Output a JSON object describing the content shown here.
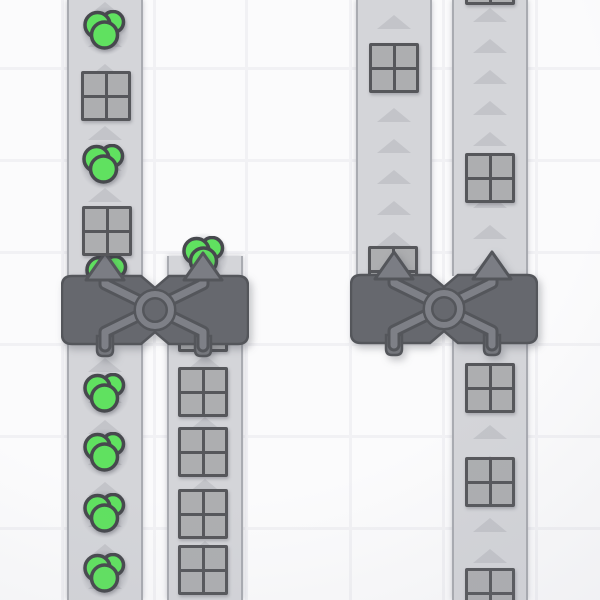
{
  "scene": {
    "description": "top-down factory game viewport: conveyor belts moving items into two balancer machines",
    "viewport": {
      "width": 600,
      "height": 600
    }
  },
  "colors": {
    "bg": "#fbfbfc",
    "grid_line": "#f1f1f4",
    "belt_surface": "#d4d5d9",
    "belt_edge": "#a9abb1",
    "belt_arrow": "#c3c4c9",
    "machine_body": "#66686e",
    "machine_outline": "#54565b",
    "machine_detail": "#7e8087",
    "machine_arrow": "#7b7d84",
    "pipe_fill": "#75777d",
    "item_outline": "#56575b",
    "item_square_fill": "#adaeb0",
    "berry_fill": "#60e160",
    "berry_outline": "#47494e",
    "halo": "rgba(98,100,112,0.13)"
  },
  "grid": {
    "v_lines": [
      62,
      154,
      246,
      350,
      443,
      536
    ],
    "h_lines": [
      68,
      160,
      252,
      344,
      436,
      528
    ]
  },
  "arrow": {
    "spacing": 31,
    "height": 14
  },
  "belts": [
    {
      "name": "belt-left-a-upper",
      "x": 67,
      "y": 0,
      "width": 76,
      "height": 278,
      "arrow_phase": 2
    },
    {
      "name": "belt-left-a-lower",
      "x": 67,
      "y": 342,
      "width": 76,
      "height": 258,
      "arrow_phase": 16
    },
    {
      "name": "belt-left-b-stub",
      "x": 167,
      "y": 256,
      "width": 76,
      "height": 22,
      "arrow_phase": 40
    },
    {
      "name": "belt-left-b-lower",
      "x": 167,
      "y": 342,
      "width": 76,
      "height": 258,
      "arrow_phase": 13
    },
    {
      "name": "belt-right-c-upper",
      "x": 356,
      "y": 0,
      "width": 76,
      "height": 276,
      "arrow_phase": 15
    },
    {
      "name": "belt-right-d-upper",
      "x": 452,
      "y": 0,
      "width": 76,
      "height": 276,
      "arrow_phase": 8
    },
    {
      "name": "belt-right-d-lower",
      "x": 452,
      "y": 340,
      "width": 76,
      "height": 260,
      "arrow_phase": 23
    }
  ],
  "machines": [
    {
      "name": "balancer-left",
      "x": 61,
      "y": 250
    },
    {
      "name": "balancer-right",
      "x": 350,
      "y": 249
    }
  ],
  "items": [
    {
      "type": "berry",
      "x": 105,
      "y": 31,
      "under": false
    },
    {
      "type": "square",
      "x": 106,
      "y": 96,
      "under": false
    },
    {
      "type": "berry",
      "x": 104,
      "y": 165,
      "under": false
    },
    {
      "type": "square",
      "x": 107,
      "y": 231,
      "under": false
    },
    {
      "type": "berry",
      "x": 107,
      "y": 276,
      "under": true
    },
    {
      "type": "berry",
      "x": 105,
      "y": 394,
      "under": false
    },
    {
      "type": "berry",
      "x": 105,
      "y": 453,
      "under": false
    },
    {
      "type": "berry",
      "x": 105,
      "y": 514,
      "under": false
    },
    {
      "type": "berry",
      "x": 105,
      "y": 574,
      "under": false
    },
    {
      "type": "berry",
      "x": 204,
      "y": 257,
      "under": true
    },
    {
      "type": "square",
      "x": 203,
      "y": 327,
      "under": true
    },
    {
      "type": "square",
      "x": 203,
      "y": 392,
      "under": false
    },
    {
      "type": "square",
      "x": 203,
      "y": 452,
      "under": false
    },
    {
      "type": "square",
      "x": 203,
      "y": 514,
      "under": false
    },
    {
      "type": "square",
      "x": 203,
      "y": 570,
      "under": false
    },
    {
      "type": "square",
      "x": 394,
      "y": 68,
      "under": false
    },
    {
      "type": "square",
      "x": 393,
      "y": 271,
      "under": true
    },
    {
      "type": "square",
      "x": 490,
      "y": -20,
      "under": false
    },
    {
      "type": "square",
      "x": 490,
      "y": 178,
      "under": false
    },
    {
      "type": "square",
      "x": 490,
      "y": 388,
      "under": false
    },
    {
      "type": "square",
      "x": 490,
      "y": 482,
      "under": false
    },
    {
      "type": "square",
      "x": 490,
      "y": 593,
      "under": false
    }
  ]
}
